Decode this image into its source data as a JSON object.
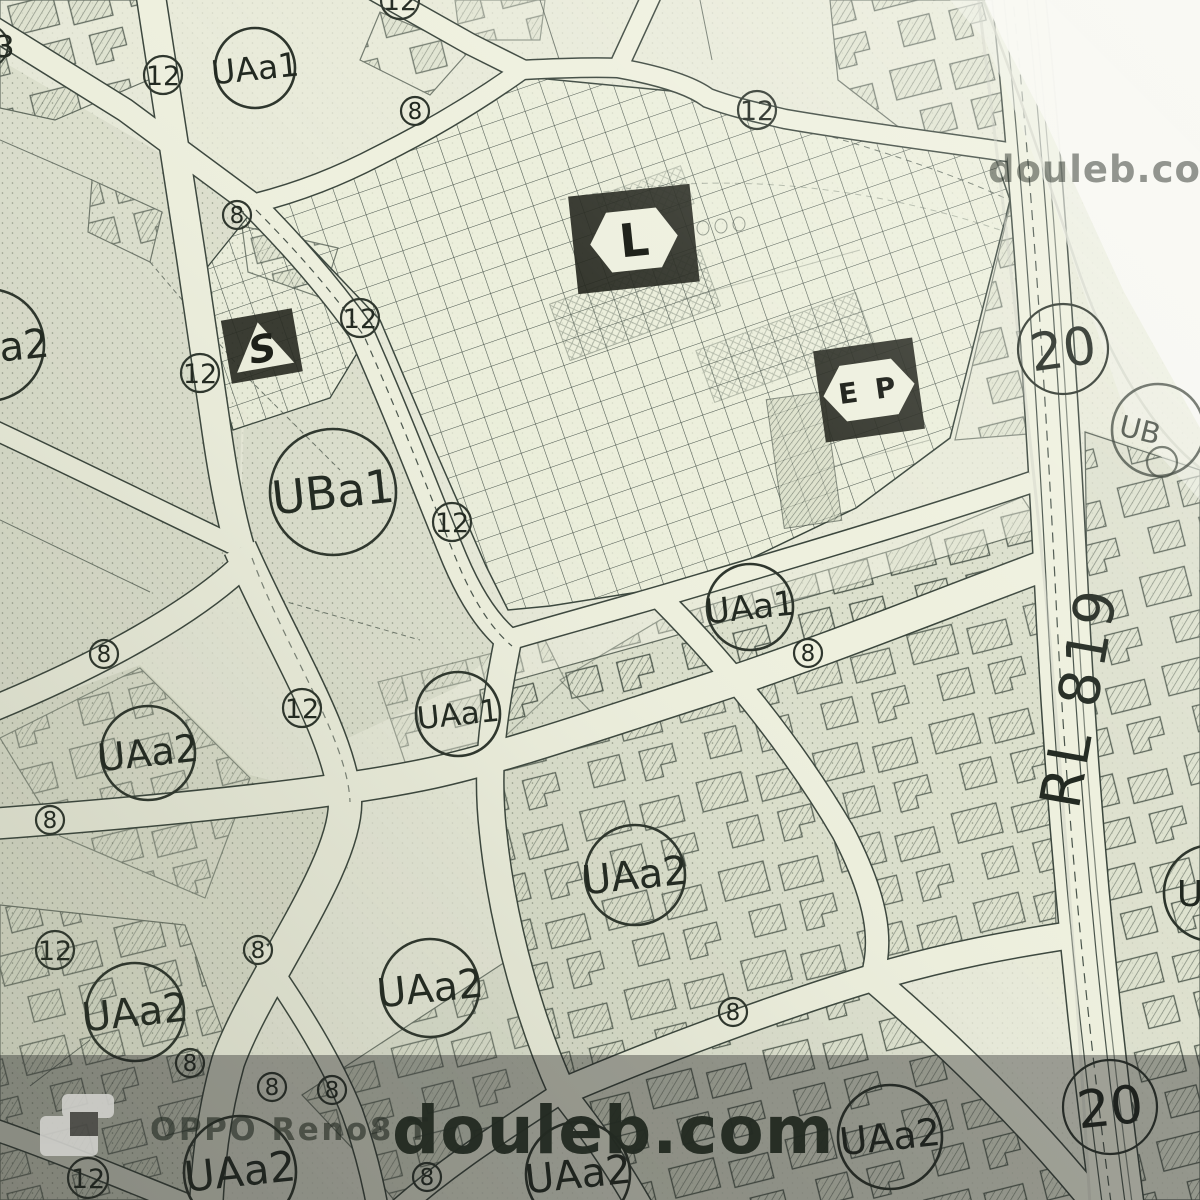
{
  "map": {
    "zones": {
      "uaa1": "UAa1",
      "uaa2": "UAa2",
      "uba1": "UBa1",
      "a2_partial": "a2",
      "ub_partial": "UB",
      "u_partial": "U"
    },
    "road_widths": {
      "n8": "8",
      "n12": "12",
      "n20": "20",
      "n3": "3"
    },
    "symbols": {
      "s": "S",
      "l": "L",
      "ep": "E P"
    },
    "road_ref": "RL 819"
  },
  "watermark": {
    "site": "douleb.com",
    "site_top_right": "douleb.com",
    "device": "OPPO Reno8 T"
  }
}
